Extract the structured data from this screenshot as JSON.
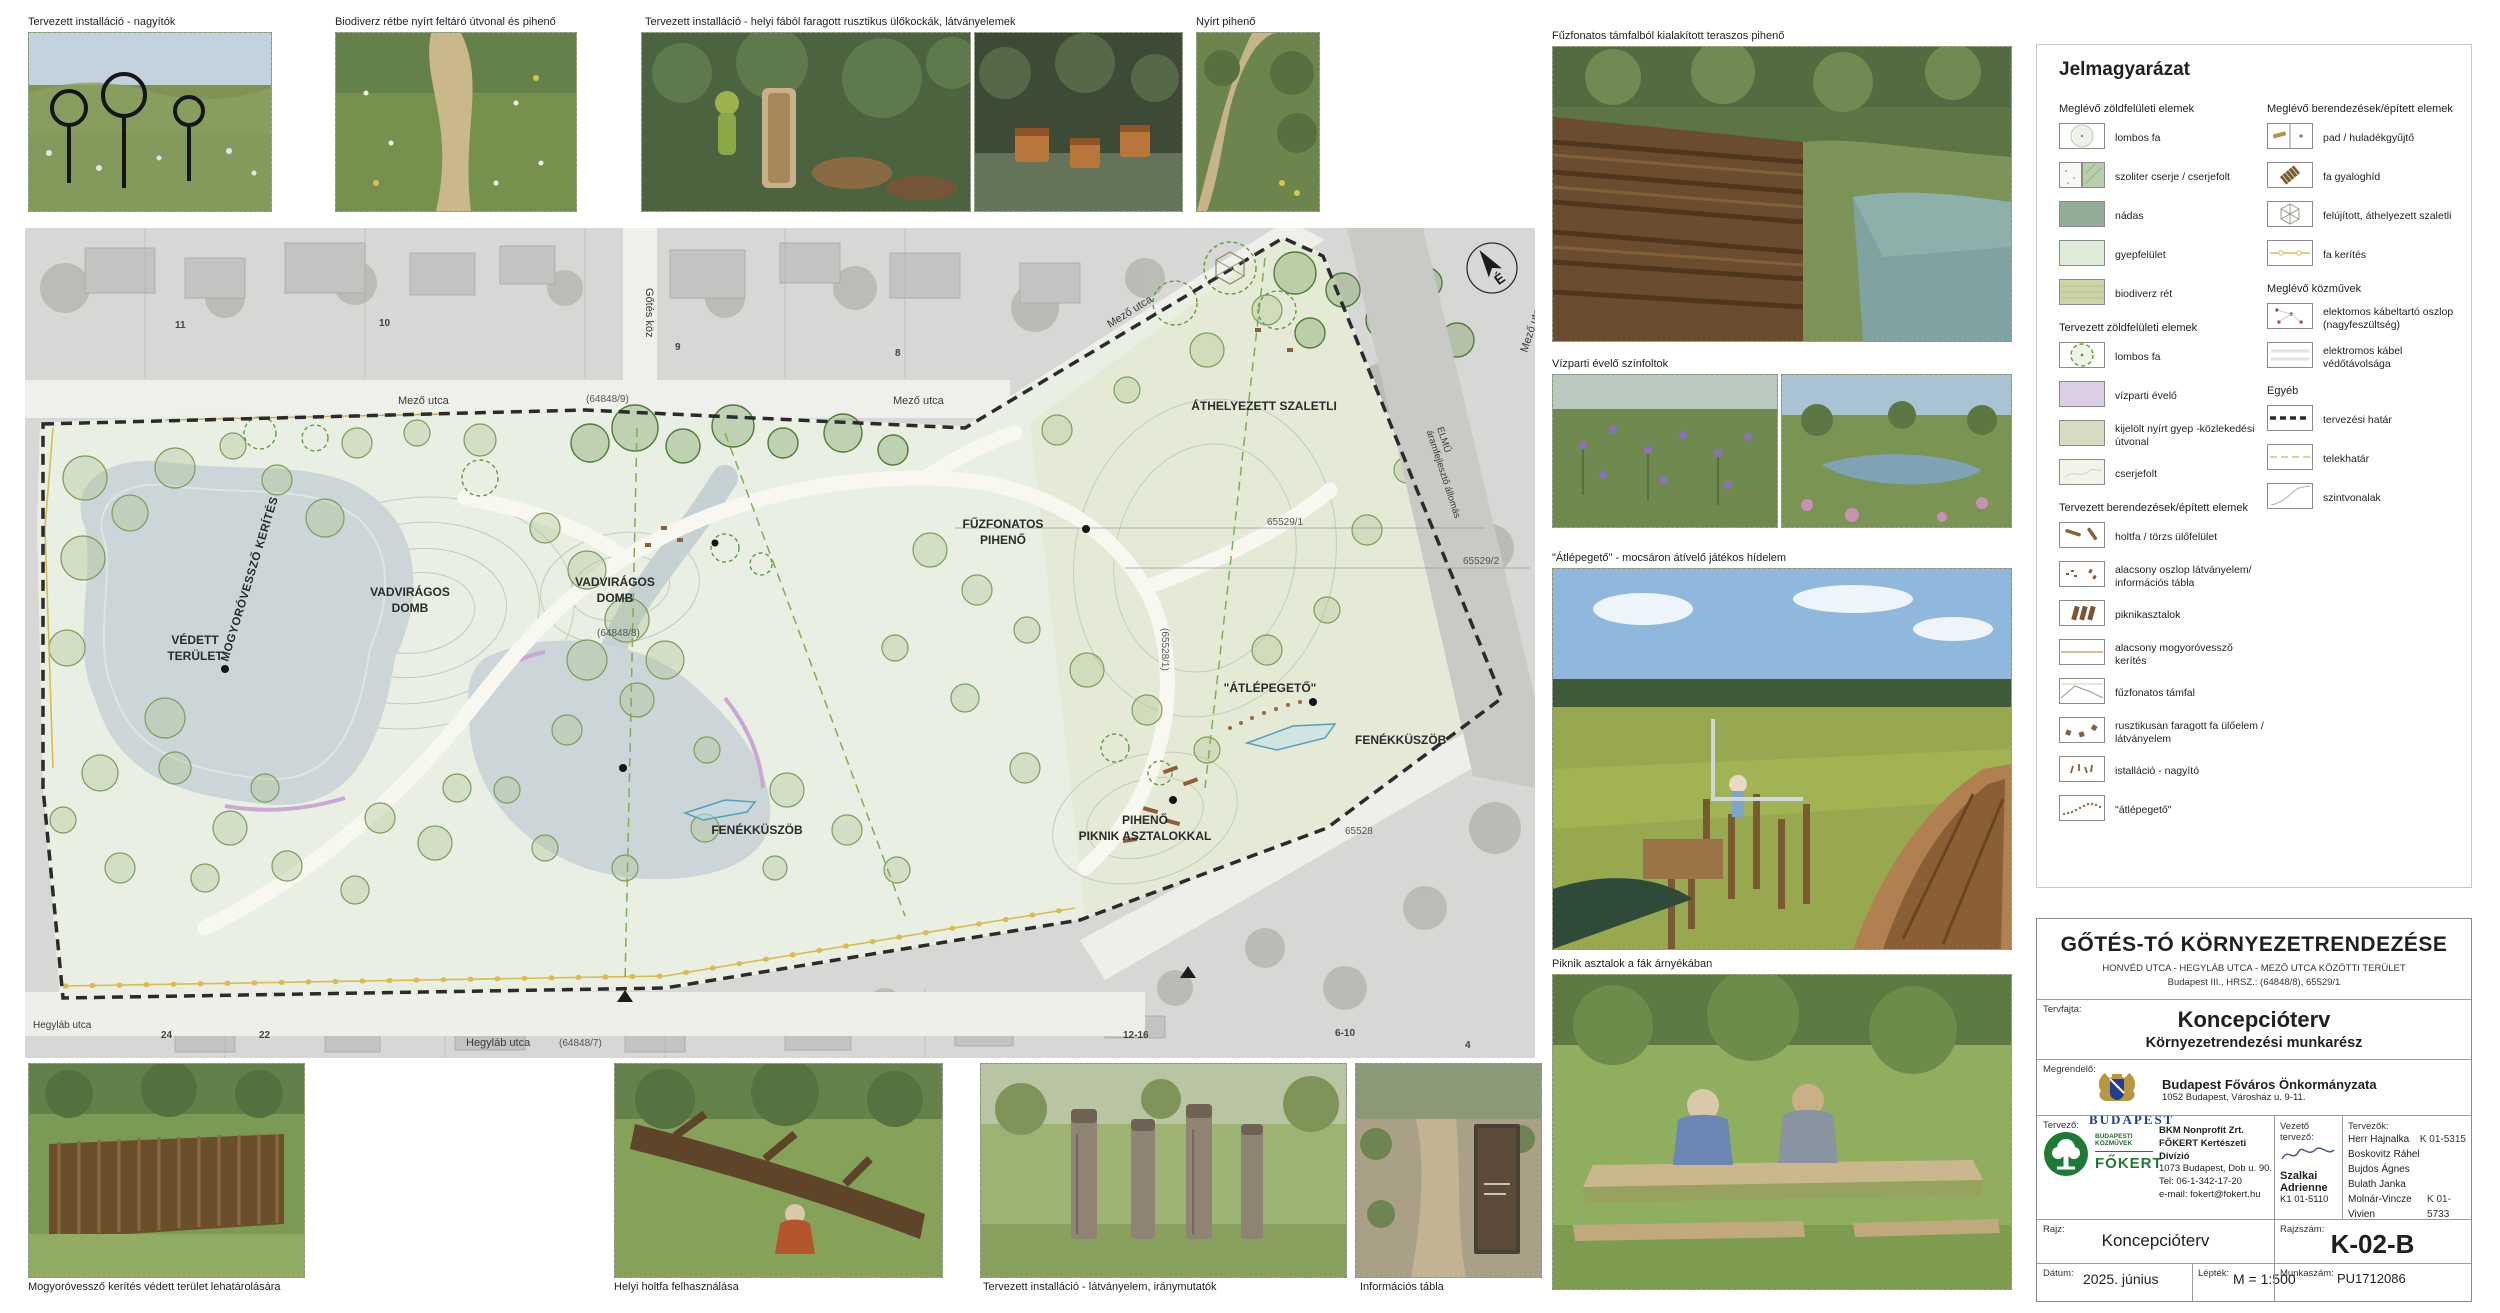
{
  "top_photos": [
    {
      "caption": "Tervezett installáció - nagyítók"
    },
    {
      "caption": "Biodiverz rétbe nyírt feltáró útvonal és pihenő"
    },
    {
      "caption": "Tervezett installáció - helyi fából faragott rusztikus ülőkockák, látványelemek"
    },
    {
      "caption": "Nyírt pihenő"
    }
  ],
  "right_photos": [
    {
      "caption": "Fűzfonatos támfalból kialakított teraszos pihenő"
    },
    {
      "caption": "Vízparti évelő színfoltok"
    },
    {
      "caption": "\"Átlépegető\" - mocsáron átívelő játékos hídelem"
    },
    {
      "caption": "Piknik asztalok a fák árnyékában"
    }
  ],
  "bottom_photos": [
    {
      "caption": "Mogyoróvessző kerítés védett terület lehatárolására"
    },
    {
      "caption": "Helyi holtfa felhasználása"
    },
    {
      "caption": "Tervezett installáció - látványelem, iránymutatók"
    },
    {
      "caption": "Információs tábla"
    }
  ],
  "legend": {
    "title": "Jelmagyarázat",
    "left": {
      "s1": "Meglévő zöldfelületi elemek",
      "items1": [
        "lombos fa",
        "szoliter cserje / cserjefolt",
        "nádas",
        "gyepfelület",
        "biodiverz rét"
      ],
      "s2": "Tervezett zöldfelületi elemek",
      "items2": [
        "lombos fa",
        "vízparti évelő",
        "kijelölt nyírt gyep -közlekedési útvonal",
        "cserjefolt"
      ],
      "s3": "Tervezett berendezések/épített elemek",
      "items3": [
        "holtfa / törzs ülőfelület",
        "alacsony oszlop látványelem/ információs tábla",
        "piknikasztalok",
        "alacsony mogyoróvessző kerítés",
        "fűzfonatos támfal",
        "rusztikusan faragott fa ülőelem / látványelem",
        "istalláció - nagyító",
        "\"átlépegető\""
      ]
    },
    "right": {
      "s1": "Meglévő berendezések/épített elemek",
      "items1": [
        "pad / huladékgyűjtő",
        "fa gyaloghíd",
        "felújított, áthelyezett szaletli",
        "fa kerítés"
      ],
      "s2": "Meglévő közművek",
      "items2": [
        "elektomos kábeltartó oszlop (nagyfeszültség)",
        "elektromos kábel védőtávolsága"
      ],
      "s3": "Egyéb",
      "items3": [
        "tervezési határ",
        "telekhatár",
        "szintvonalak"
      ]
    }
  },
  "plan": {
    "north_letter": "É",
    "labels": {
      "mogyorovesszo_kerites": "MOGYORÓVESSZŐ KERÍTÉS",
      "vedett": [
        "VÉDETT",
        "TERÜLET"
      ],
      "vadviragos": [
        "VADVIRÁGOS",
        "DOMB"
      ],
      "fuzfonatos_piheno": [
        "FŰZFONATOS",
        "PIHENŐ"
      ],
      "athelyezett_szaletli": "ÁTHELYEZETT SZALETLI",
      "atlepegeto": "\"ÁTLÉPEGETŐ\"",
      "fenekkuszob": "FENÉKKÜSZÖB",
      "piheno_piknik": [
        "PIHENŐ",
        "PIKNIK ASZTALOKKAL"
      ]
    },
    "streets": {
      "mezo": "Mező utca",
      "gotes_koz": "Gőtés köz",
      "hegylab": "Hegyláb utca",
      "elmu": [
        "ELMŰ",
        "áramfejlesztő állomás"
      ]
    },
    "parcels": {
      "p64848_9": "(64848/9)",
      "p64848_8": "(64848/8)",
      "p64848_7": "(64848/7)",
      "p65528_1": "(65528/1)",
      "p65529_1": "65529/1",
      "p65529_2": "65529/2",
      "p65528": "65528"
    },
    "house_numbers": [
      "11",
      "10",
      "9",
      "8",
      "24",
      "22",
      "12-16",
      "6-10",
      "4"
    ]
  },
  "titleblock": {
    "title": "GŐTÉS-TÓ KÖRNYEZETRENDEZÉSE",
    "subtitle1": "HONVÉD UTCA - HEGYLÁB UTCA - MEZŐ UTCA KÖZÖTTI TERÜLET",
    "subtitle2": "Budapest III., HRSZ.: (64848/8),  65529/1",
    "tervfajta_label": "Tervfajta:",
    "tervfajta_value": "Koncepcióterv",
    "tervfajta_value2": "Környezetrendezési munkarész",
    "megrendelo_label": "Megrendelő:",
    "megrendelo_name": "Budapest Főváros Önkormányzata",
    "megrendelo_address": "1052 Budapest, Városház u. 9-11.",
    "budapest_logo": "BUDAPEST",
    "tervezo_label": "Tervező:",
    "fokert_small1": "BUDAPESTI",
    "fokert_small2": "KÖZMŰVEK",
    "fokert_logo": "FŐKERT",
    "company1": "BKM Nonprofit Zrt.",
    "company2": "FŐKERT Kertészeti Divízió",
    "company_addr": "1073 Budapest, Dob u. 90.",
    "company_tel": "Tel: 06-1-342-17-20",
    "company_email": "e-mail: fokert@fokert.hu",
    "vezeto_label": "Vezető tervező:",
    "vezeto_name": "Szalkai Adrienne",
    "vezeto_reg": "K1 01-5110",
    "tervezok_label": "Tervezők:",
    "tervezok": [
      {
        "name": "Herr Hajnalka",
        "reg": "K 01-5315"
      },
      {
        "name": "Boskovitz Ráhel",
        "reg": ""
      },
      {
        "name": "Bujdos Ágnes",
        "reg": ""
      },
      {
        "name": "Bulath Janka",
        "reg": ""
      },
      {
        "name": "Molnár-Vincze Vivien",
        "reg": "K 01-5733"
      }
    ],
    "rajz_label": "Rajz:",
    "rajz_value": "Koncepcióterv",
    "rajzszam_label": "Rajzszám:",
    "rajzszam_value": "K-02-B",
    "datum_label": "Dátum:",
    "datum_value": "2025. június",
    "leptek_label": "Lépték:",
    "leptek_value": "M = 1:500",
    "munkaszam_label": "Munkaszám:",
    "munkaszam_value": "PU1712086"
  },
  "colors": {
    "fokert_green": "#1e7a34",
    "budapest_navy": "#1c3f94",
    "budapest_gold": "#b8963e",
    "park_green": "#e9efe3",
    "lake_grey_blue": "#ccd6d8"
  }
}
